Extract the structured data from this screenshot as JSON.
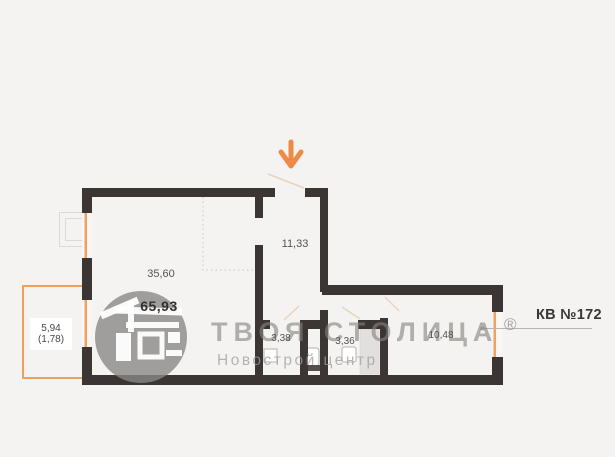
{
  "apartment": {
    "label": "КВ №172",
    "total_area": "65,93"
  },
  "rooms": [
    {
      "id": "living-room",
      "area": "35,60"
    },
    {
      "id": "entrance-hall",
      "area": "11,33"
    },
    {
      "id": "wc",
      "area": "3,38"
    },
    {
      "id": "bathroom",
      "area": "3,36"
    },
    {
      "id": "corridor",
      "area": "10,48"
    },
    {
      "id": "balcony",
      "area": "5,94",
      "area_reduced": "(1,78)"
    }
  ],
  "watermark": {
    "brand": "ТВОЯ СТОЛИЦА",
    "registered_mark": "®",
    "subtitle": "Новострой центр",
    "logo": "tvoya-stolitsa-house-logo"
  },
  "icons": {
    "entrance_arrow": "orange-down-arrow"
  },
  "colors": {
    "background": "#f4f3f2",
    "walls": "#3b3533",
    "accent_orange": "#ed8b46",
    "window_orange": "#eda361",
    "balcony_outline": "#eda05c",
    "door_swing": "#e6d5bd",
    "watermark_grey": "#a3a2a1",
    "label_text": "#56524f",
    "total_text": "#34302d"
  }
}
